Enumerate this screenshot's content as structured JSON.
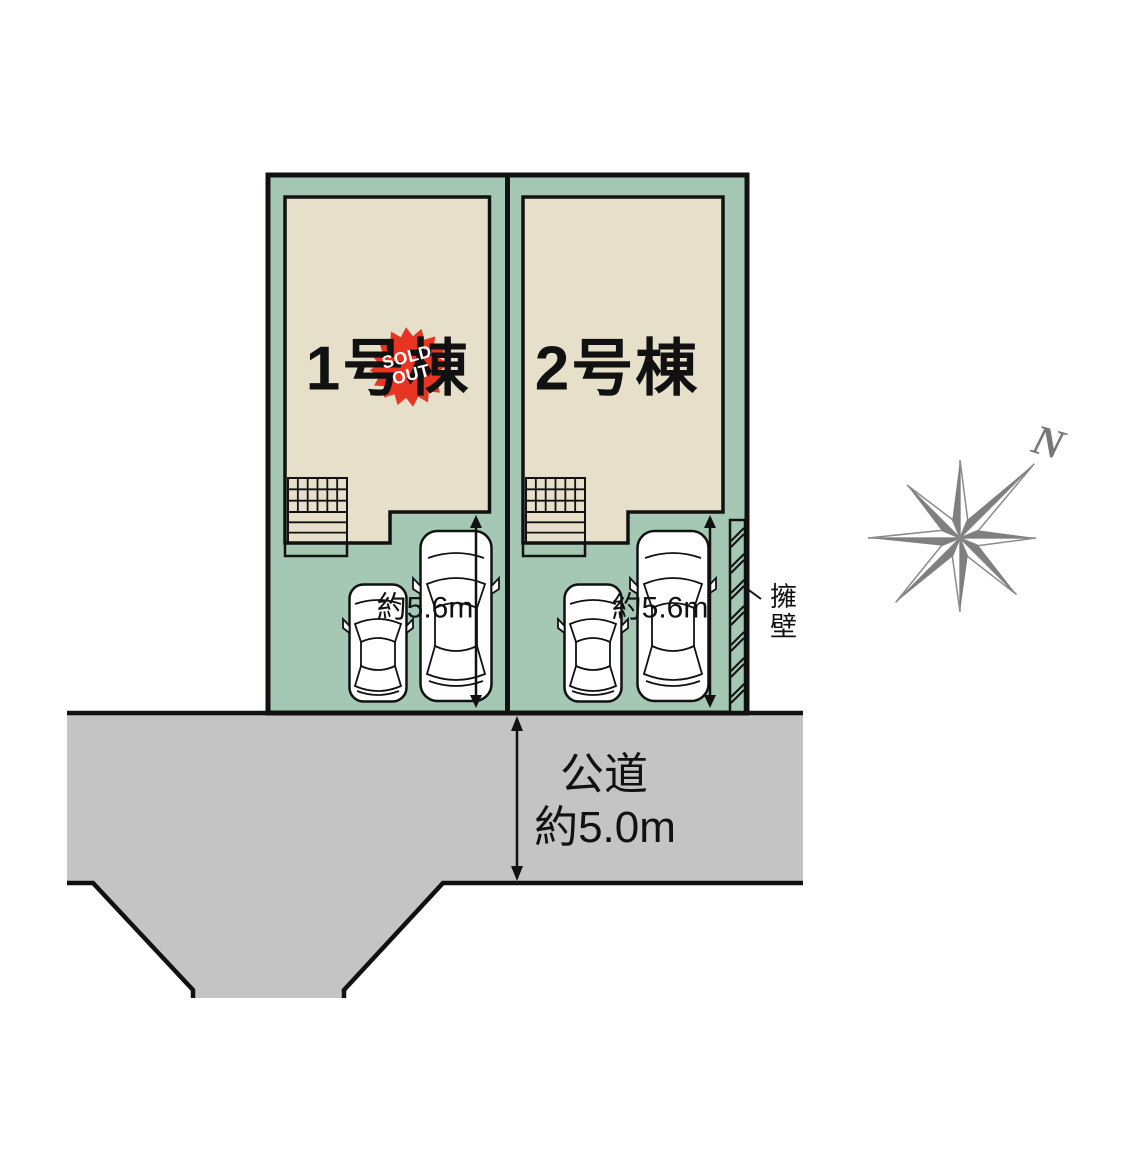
{
  "title": "分譲区画図",
  "colors": {
    "lot_green": "#a5c8b5",
    "building_beige": "#e6dfca",
    "road_gray": "#c4c4c5",
    "line_black": "#111111",
    "badge_red": "#e83423",
    "badge_text_white": "#ffffff",
    "compass_gray": "#7f7f7f"
  },
  "site_plan": {
    "lots": [
      {
        "id": "lot-1",
        "label": "1号棟",
        "parking_depth": "約5.6m",
        "sold_out": true
      },
      {
        "id": "lot-2",
        "label": "2号棟",
        "parking_depth": "約5.6m",
        "sold_out": false
      }
    ],
    "sold_badge": {
      "line1": "SOLD",
      "line2": "OUT"
    },
    "road": {
      "label": "公道",
      "width_label": "約5.0m"
    },
    "retaining_wall": {
      "label": "擁壁"
    },
    "compass": {
      "north_label": "N"
    }
  }
}
